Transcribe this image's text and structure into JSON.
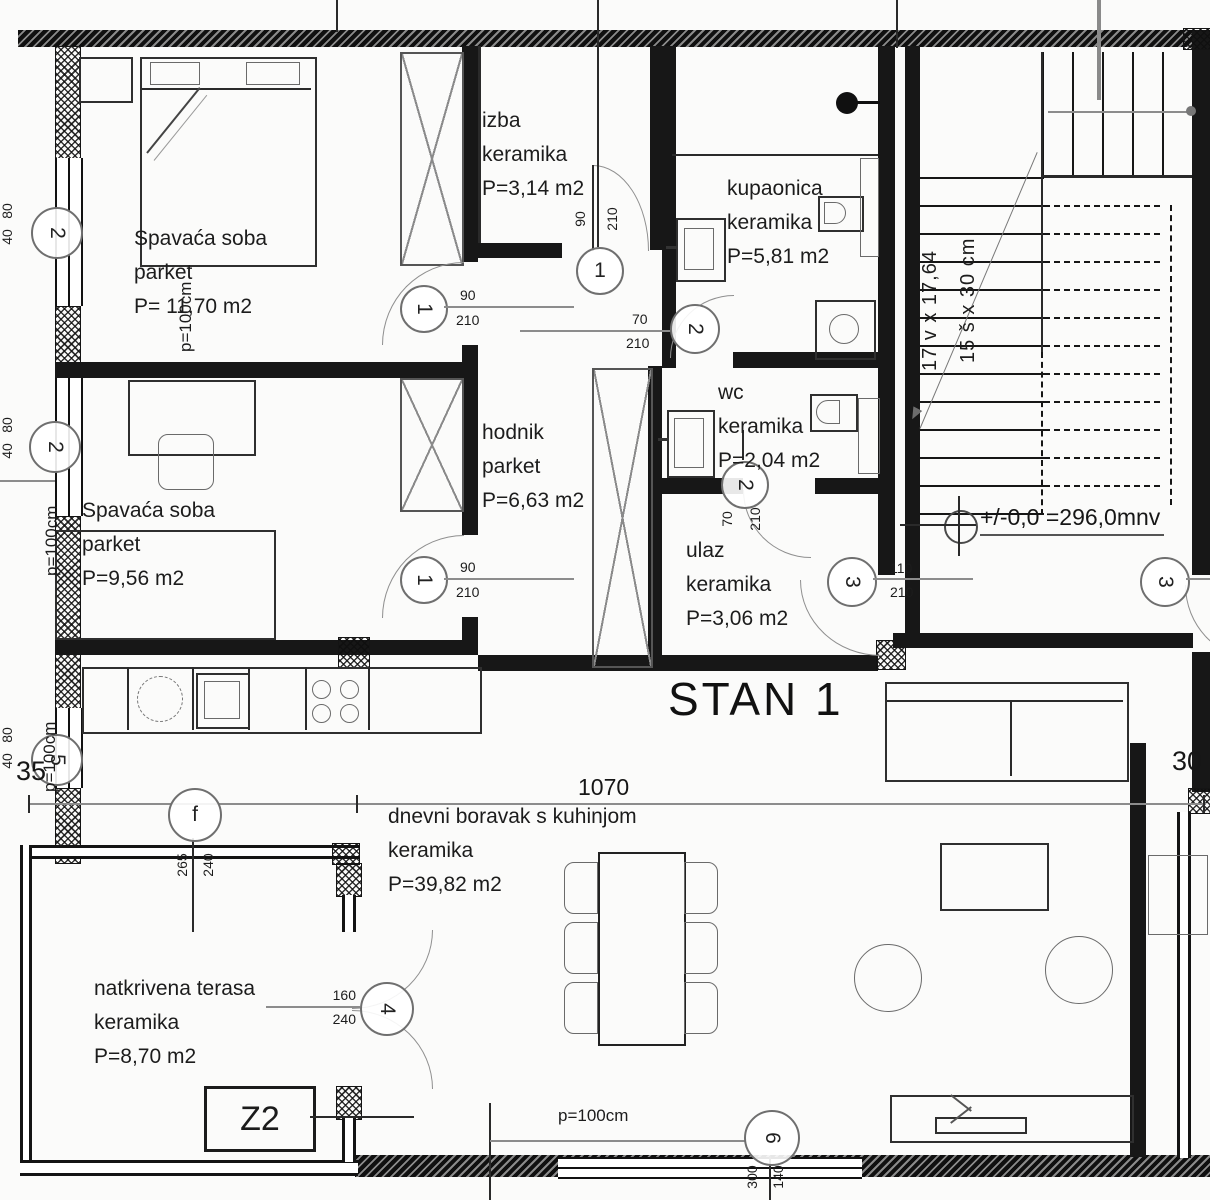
{
  "plan": {
    "title": "STAN 1",
    "zone_label": "Z2",
    "overall_dim": "1070",
    "level_marker": "+/-0,0 =296,0mnv",
    "wall_dim_left": "35",
    "wall_dim_right": "30",
    "parapet_label": "p=100cm",
    "stairs_risers": "17 v x 17,64",
    "stairs_treads": "15 š x 30 cm"
  },
  "rooms": {
    "bedroom1": {
      "name": "Spavaća soba",
      "finish": "parket",
      "area": "P= 11,70 m2"
    },
    "bedroom2": {
      "name": "Spavaća soba",
      "finish": "parket",
      "area": "P=9,56 m2"
    },
    "pantry": {
      "name": "izba",
      "finish": "keramika",
      "area": "P=3,14 m2"
    },
    "bathroom": {
      "name": "kupaonica",
      "finish": "keramika",
      "area": "P=5,81 m2"
    },
    "wc": {
      "name": "wc",
      "finish": "keramika",
      "area": "P=2,04 m2"
    },
    "hallway": {
      "name": "hodnik",
      "finish": "parket",
      "area": "P=6,63 m2"
    },
    "entry": {
      "name": "ulaz",
      "finish": "keramika",
      "area": "P=3,06 m2"
    },
    "living": {
      "name": "dnevni boravak s kuhinjom",
      "finish": "keramika",
      "area": "P=39,82 m2"
    },
    "terrace": {
      "name": "natkrivena terasa",
      "finish": "keramika",
      "area": "P=8,70 m2"
    }
  },
  "openings": {
    "bedroom1_door": {
      "mark": "1",
      "w": "90",
      "h": "210"
    },
    "bedroom2_door": {
      "mark": "1",
      "w": "90",
      "h": "210"
    },
    "pantry_door": {
      "mark": "1",
      "w": "90",
      "h": "210"
    },
    "bathroom_door": {
      "mark": "2",
      "w": "70",
      "h": "210"
    },
    "wc_door": {
      "mark": "2",
      "w": "70",
      "h": "210"
    },
    "entry_door": {
      "mark": "3",
      "w": "110",
      "h": "210"
    },
    "stair_door_right": {
      "mark": "3"
    },
    "terrace_door": {
      "mark": "4",
      "w": "160",
      "h": "240"
    },
    "window_left_upper": {
      "mark": "2",
      "w": "80",
      "h": "40"
    },
    "window_left_mid": {
      "mark": "2",
      "w": "80",
      "h": "40"
    },
    "window_left_lower": {
      "mark": "5",
      "w": "80",
      "h": "40"
    },
    "terrace_window": {
      "mark": "f",
      "w": "265",
      "h": "240"
    },
    "living_window": {
      "mark": "6",
      "w": "300",
      "h": "140"
    }
  }
}
